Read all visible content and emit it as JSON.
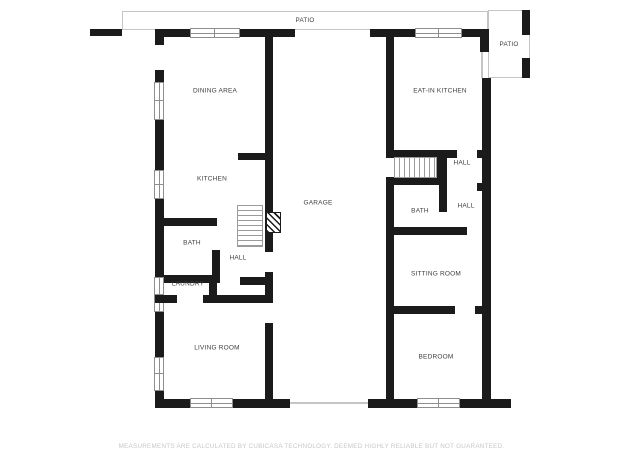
{
  "plan": {
    "title": "First floor plan",
    "rooms": {
      "patio_top": {
        "label": "PATIO"
      },
      "patio_right": {
        "label": "PATIO"
      },
      "dining_area": {
        "label": "DINING AREA"
      },
      "eat_in_kitchen": {
        "label": "EAT-IN KITCHEN"
      },
      "kitchen": {
        "label": "KITCHEN"
      },
      "garage": {
        "label": "GARAGE"
      },
      "hall_upper_right": {
        "label": "HALL"
      },
      "hall_lower_right": {
        "label": "HALL"
      },
      "bath_right": {
        "label": "BATH"
      },
      "sitting_room": {
        "label": "SITTING ROOM"
      },
      "bath_left": {
        "label": "BATH"
      },
      "hall_left": {
        "label": "HALL"
      },
      "laundry": {
        "label": "LAUNDRY"
      },
      "living_room": {
        "label": "LIVING ROOM"
      },
      "bedroom": {
        "label": "BEDROOM"
      }
    },
    "footer": {
      "disclaimer": "MEASUREMENTS ARE CALCULATED BY CUBICASA TECHNOLOGY. DEEMED HIGHLY RELIABLE BUT NOT GUARANTEED."
    },
    "colors": {
      "wall": "#1b1b1b",
      "outline": "#c5c5c5",
      "window_frame": "#8e8e8e",
      "label_text": "#3d3d3d",
      "disclaimer_text": "#c7c7cb",
      "background": "#ffffff"
    }
  }
}
